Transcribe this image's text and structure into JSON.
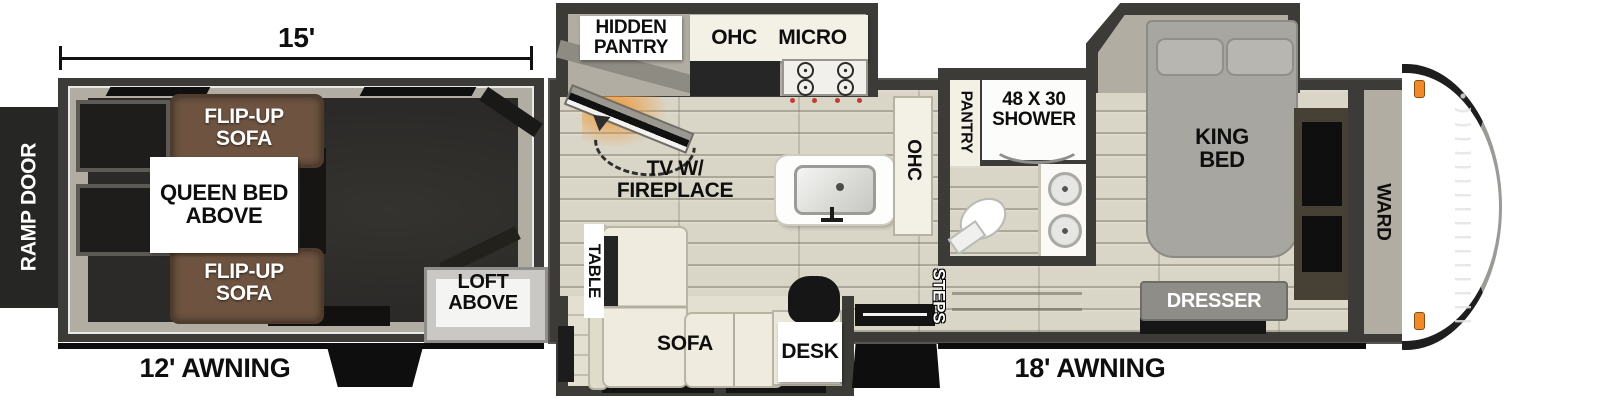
{
  "plan_title": "Toy hauler fifth-wheel floorplan",
  "dimensions": {
    "garage_length_label": "15'",
    "left_awning_label": "12' AWNING",
    "right_awning_label": "18' AWNING"
  },
  "exterior": {
    "ramp_door_label": "RAMP DOOR"
  },
  "garage": {
    "flip_up_sofa_top_label": "FLIP-UP\nSOFA",
    "queen_bed_label": "QUEEN BED\nABOVE",
    "flip_up_sofa_bottom_label": "FLIP-UP\nSOFA",
    "loft_label": "LOFT ABOVE"
  },
  "kitchen": {
    "hidden_pantry_label": "HIDDEN\nPANTRY",
    "ohc_top_label": "OHC",
    "micro_label": "MICRO",
    "tv_fireplace_label": "TV W/\nFIREPLACE",
    "ohc_side_label": "OHC",
    "pantry_label": "PANTRY"
  },
  "living": {
    "table_label": "TABLE",
    "sofa_label": "SOFA",
    "desk_label": "DESK"
  },
  "bathroom": {
    "shower_label": "48 X 30\nSHOWER",
    "steps_label": "STEPS"
  },
  "bedroom": {
    "king_bed_label": "KING\nBED",
    "dresser_label": "DRESSER",
    "ward_label": "WARD"
  },
  "colors": {
    "wall": "#3c3b38",
    "interior_wall": "#b1ada2",
    "garage_floor": "#2b2a28",
    "main_floor": "#d9d5c7",
    "sofa_brown": "#6d5340",
    "cushion_cream": "#efecdf",
    "cabinet_cream": "#f3f0e5",
    "bed_gray": "#a8a6a1",
    "dresser_gray": "#8f8d88",
    "fireplace_orange": "#f0942e",
    "marker_light_orange": "#f08a28",
    "stove_knob_red": "#c23a32"
  }
}
